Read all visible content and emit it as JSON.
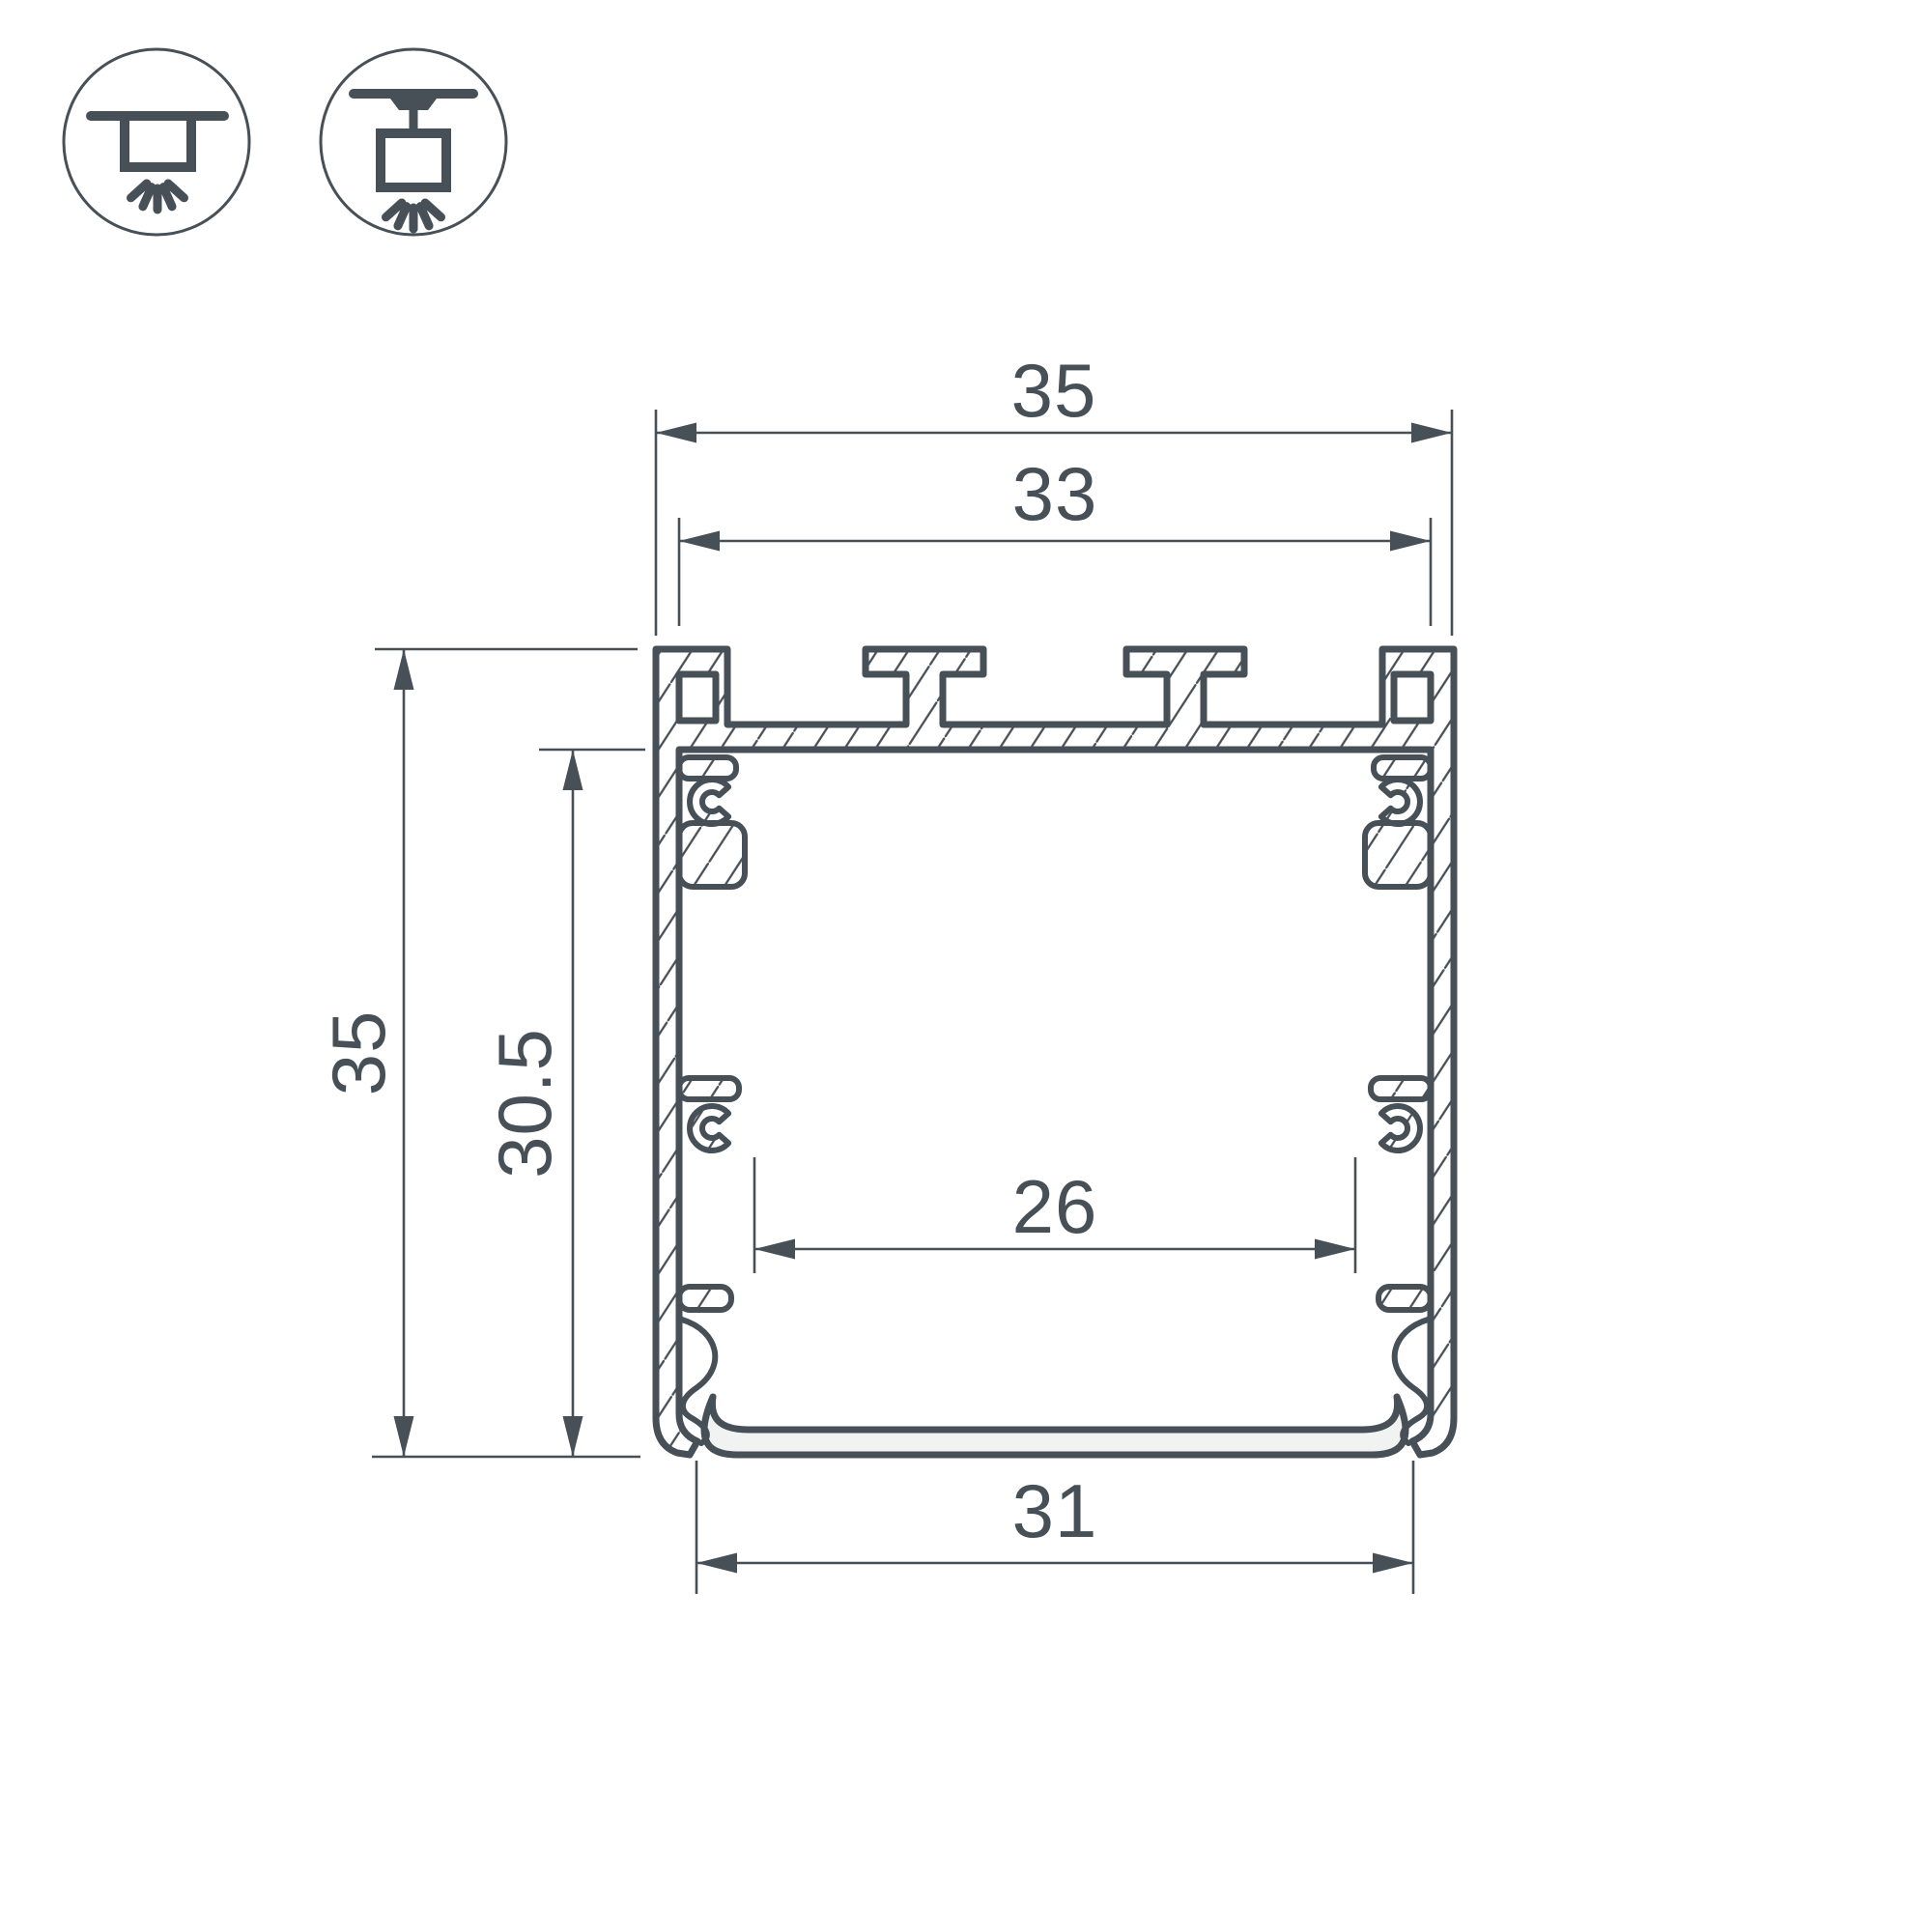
{
  "diagram": {
    "title": "LED aluminium profile cross-section technical drawing",
    "dimensions_mm": {
      "outer_width": "35",
      "top_inner_width": "33",
      "outer_height": "35",
      "inner_height": "30.5",
      "inner_bottom_width": "26",
      "bottom_width": "31"
    },
    "mount_icons": [
      {
        "name": "surface-mount-light-icon"
      },
      {
        "name": "pendant-mount-light-icon"
      }
    ],
    "colors": {
      "line": "#474F57",
      "metal_fill": "#EBECEC",
      "background": "#FFFFFF"
    }
  }
}
